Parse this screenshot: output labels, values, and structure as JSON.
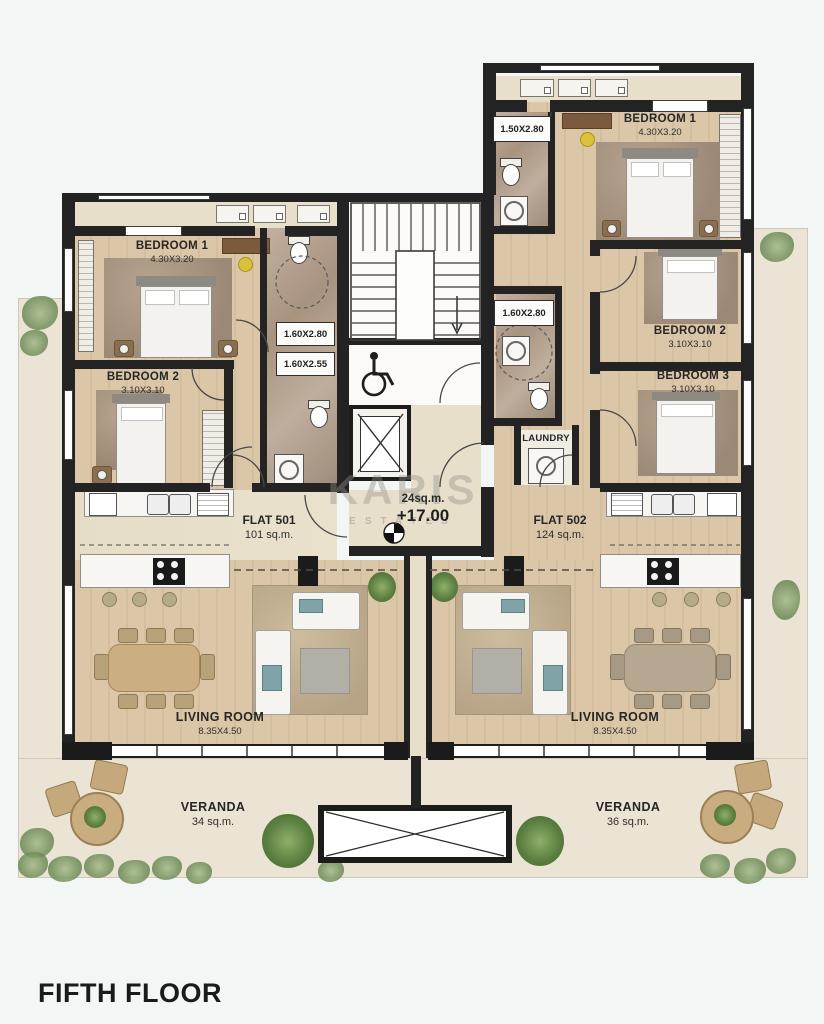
{
  "title": "FIFTH FLOOR",
  "watermark": {
    "name": "KARIS",
    "sub": "ESTATES"
  },
  "core": {
    "area": "24sq.m.",
    "level": "+17.00"
  },
  "flats": {
    "f501": {
      "name": "FLAT 501",
      "area": "101 sq.m.",
      "bedroom1": {
        "label": "BEDROOM 1",
        "dims": "4.30X3.20"
      },
      "bedroom2": {
        "label": "BEDROOM 2",
        "dims": "3.10X3.10"
      },
      "bath_dims": [
        "1.60X2.80",
        "1.60X2.55"
      ],
      "living": {
        "label": "LIVING ROOM",
        "dims": "8.35X4.50"
      },
      "veranda": {
        "label": "VERANDA",
        "area": "34 sq.m."
      }
    },
    "f502": {
      "name": "FLAT 502",
      "area": "124 sq.m.",
      "bath_top": "1.50X2.80",
      "bedroom1": {
        "label": "BEDROOM 1",
        "dims": "4.30X3.20"
      },
      "bedroom2": {
        "label": "BEDROOM 2",
        "dims": "3.10X3.10"
      },
      "bedroom3": {
        "label": "BEDROOM 3",
        "dims": "3.10X3.10"
      },
      "bath_mid": "1.60X2.80",
      "laundry": "LAUNDRY",
      "living": {
        "label": "LIVING ROOM",
        "dims": "8.35X4.50"
      },
      "veranda": {
        "label": "VERANDA",
        "area": "36 sq.m."
      }
    }
  },
  "colors": {
    "wall": "#232323",
    "wood_floor": "#d8c3a2",
    "hall_tile": "#e7dfca",
    "veranda_tile": "#ebe4d4",
    "bath_marble": "#b3a08c",
    "greenery": "#5d8142",
    "accent_chair": "#d9c23a",
    "watermark_gray": "#918e88"
  }
}
